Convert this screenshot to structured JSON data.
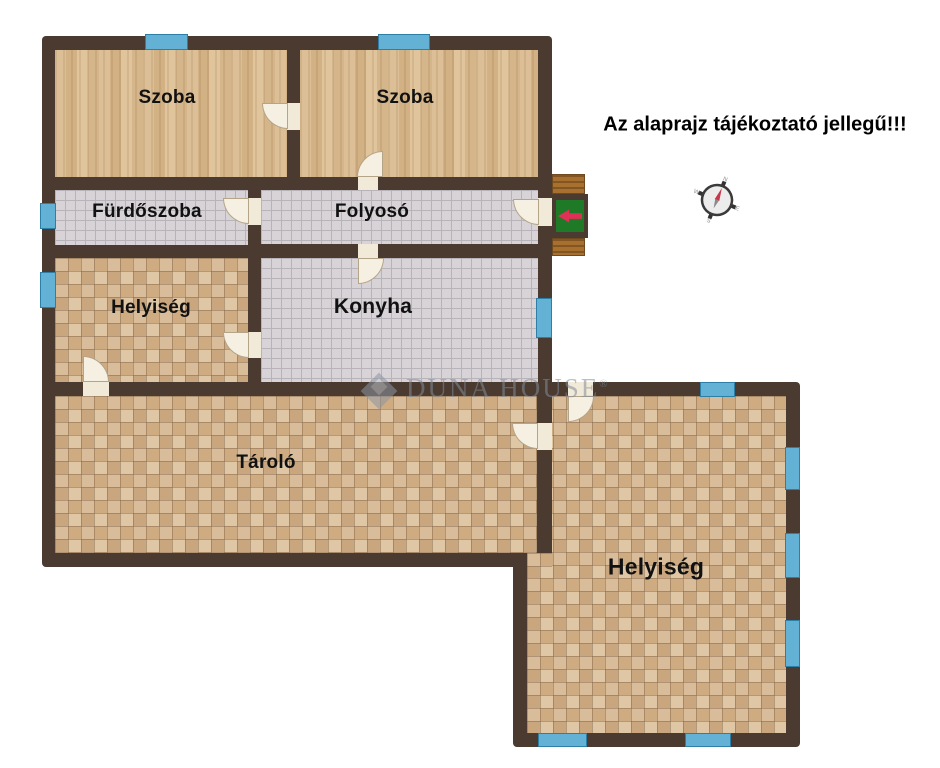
{
  "disclaimer": "Az alaprajz tájékoztató jellegű!!!",
  "rooms": [
    {
      "id": "szoba-left",
      "label": "Szoba"
    },
    {
      "id": "szoba-right",
      "label": "Szoba"
    },
    {
      "id": "furdoszoba",
      "label": "Fürdőszoba"
    },
    {
      "id": "folyoso",
      "label": "Folyosó"
    },
    {
      "id": "helyiseg-left",
      "label": "Helyiség"
    },
    {
      "id": "konyha",
      "label": "Konyha"
    },
    {
      "id": "tarolo",
      "label": "Tároló"
    },
    {
      "id": "helyiseg-right",
      "label": "Helyiség"
    }
  ],
  "watermark": {
    "brand": "DUNA HOUSE",
    "registered": "®"
  },
  "compass": {
    "n": "N",
    "e": "E",
    "s": "S",
    "w": "W"
  },
  "colors": {
    "wall": "#4a3a2f",
    "window_blue": "#64b1d6",
    "wood_floor": "#d9b88c",
    "gray_tile": "#d7d3d7",
    "terracotta_tile": "#d6bb97",
    "doormat_green": "#1f7a28",
    "entry_arrow_red": "#e03055",
    "watermark_gray": "#828c99"
  }
}
